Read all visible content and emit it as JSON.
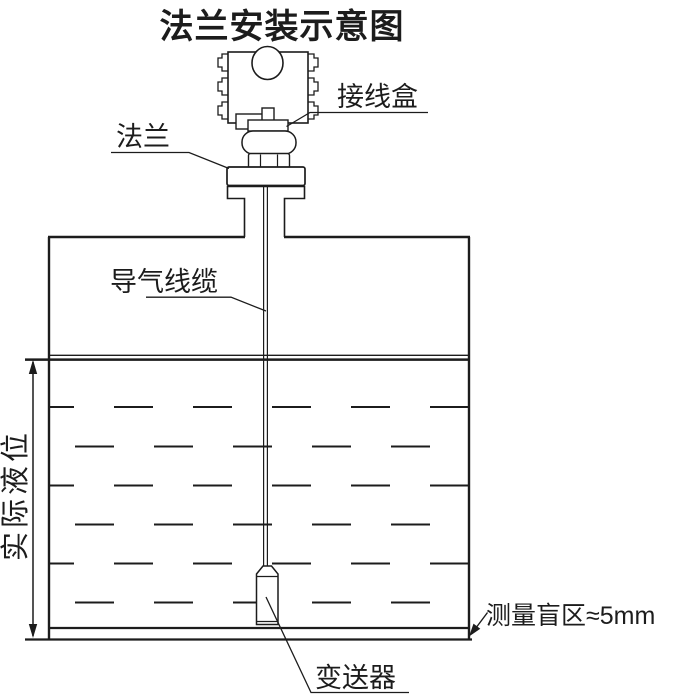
{
  "diagram": {
    "title": "法兰安装示意图",
    "labels": {
      "junction_box": "接线盒",
      "flange": "法兰",
      "air_cable": "导气线缆",
      "actual_level": "实际液位",
      "transmitter": "变送器",
      "blind_zone": "测量盲区≈5mm"
    },
    "colors": {
      "line": "#1c1c1c",
      "background": "#ffffff"
    }
  }
}
